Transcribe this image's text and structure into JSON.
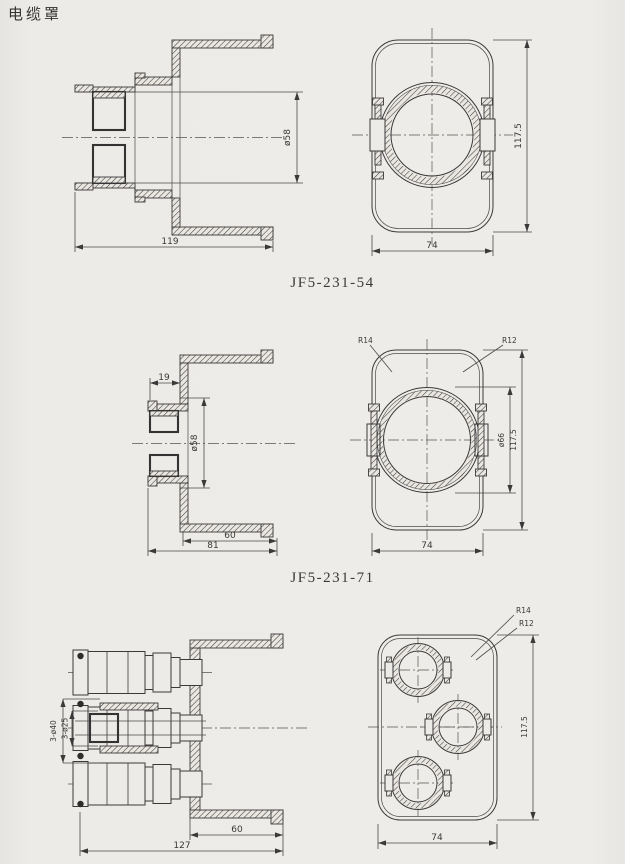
{
  "page": {
    "title": "电缆罩"
  },
  "figures": [
    {
      "caption": "JF5-231-54",
      "section": {
        "dia": "ø58",
        "len": "119"
      },
      "front": {
        "height": "117.5",
        "width": "74"
      }
    },
    {
      "caption": "JF5-231-71",
      "section": {
        "nozzle_len": "19",
        "dia": "ø58",
        "depth": "60",
        "len": "81"
      },
      "front": {
        "r_outer": "R14",
        "r_inner": "R12",
        "bore": "ø66",
        "height": "117.5",
        "width": "74"
      }
    },
    {
      "section": {
        "holes_large": "3-ø40",
        "holes_small": "3-ø25",
        "depth": "60",
        "len": "127"
      },
      "front": {
        "r_outer": "R14",
        "r_inner": "R12",
        "height": "117.5",
        "width": "74"
      }
    }
  ]
}
